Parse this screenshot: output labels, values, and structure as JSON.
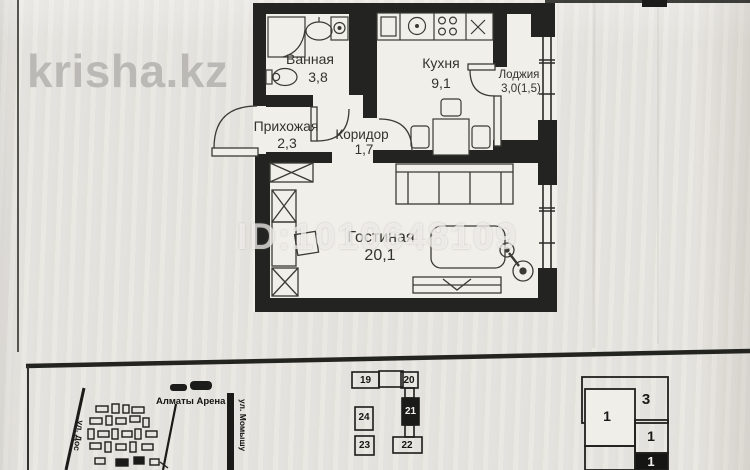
{
  "watermarks": {
    "site": "krisha.kz",
    "listing_id": "ID:1010648109"
  },
  "floor_plan": {
    "rooms": [
      {
        "id": "bathroom",
        "label": "Ванная",
        "area": "3,8"
      },
      {
        "id": "kitchen",
        "label": "Кухня",
        "area": "9,1"
      },
      {
        "id": "loggia",
        "label": "Лоджия",
        "area": "3,0(1,5)"
      },
      {
        "id": "hallway",
        "label": "Прихожая",
        "area": "2,3"
      },
      {
        "id": "corridor",
        "label": "Коридор",
        "area": "1,7"
      },
      {
        "id": "living_room",
        "label": "Гостиная",
        "area": "20,1"
      }
    ]
  },
  "location_map": {
    "place_label": "Алматы Арена",
    "street_vertical": "ул. Момышу",
    "street_left": "ул. Дос"
  },
  "site_plan": {
    "buildings": [
      {
        "number": "19",
        "highlighted": false
      },
      {
        "number": "20",
        "highlighted": false
      },
      {
        "number": "21",
        "highlighted": true
      },
      {
        "number": "22",
        "highlighted": false
      },
      {
        "number": "23",
        "highlighted": false
      },
      {
        "number": "24",
        "highlighted": false
      }
    ]
  },
  "unit_plan": {
    "units": [
      {
        "number": "3",
        "highlighted": false
      },
      {
        "number": "1",
        "highlighted": false
      },
      {
        "number": "1",
        "highlighted": false
      },
      {
        "number": "1",
        "highlighted": true
      }
    ]
  },
  "colors": {
    "paper": "#e9e7e2",
    "wall_ink": "#232421",
    "watermark_gray": "#b8b6b2"
  }
}
